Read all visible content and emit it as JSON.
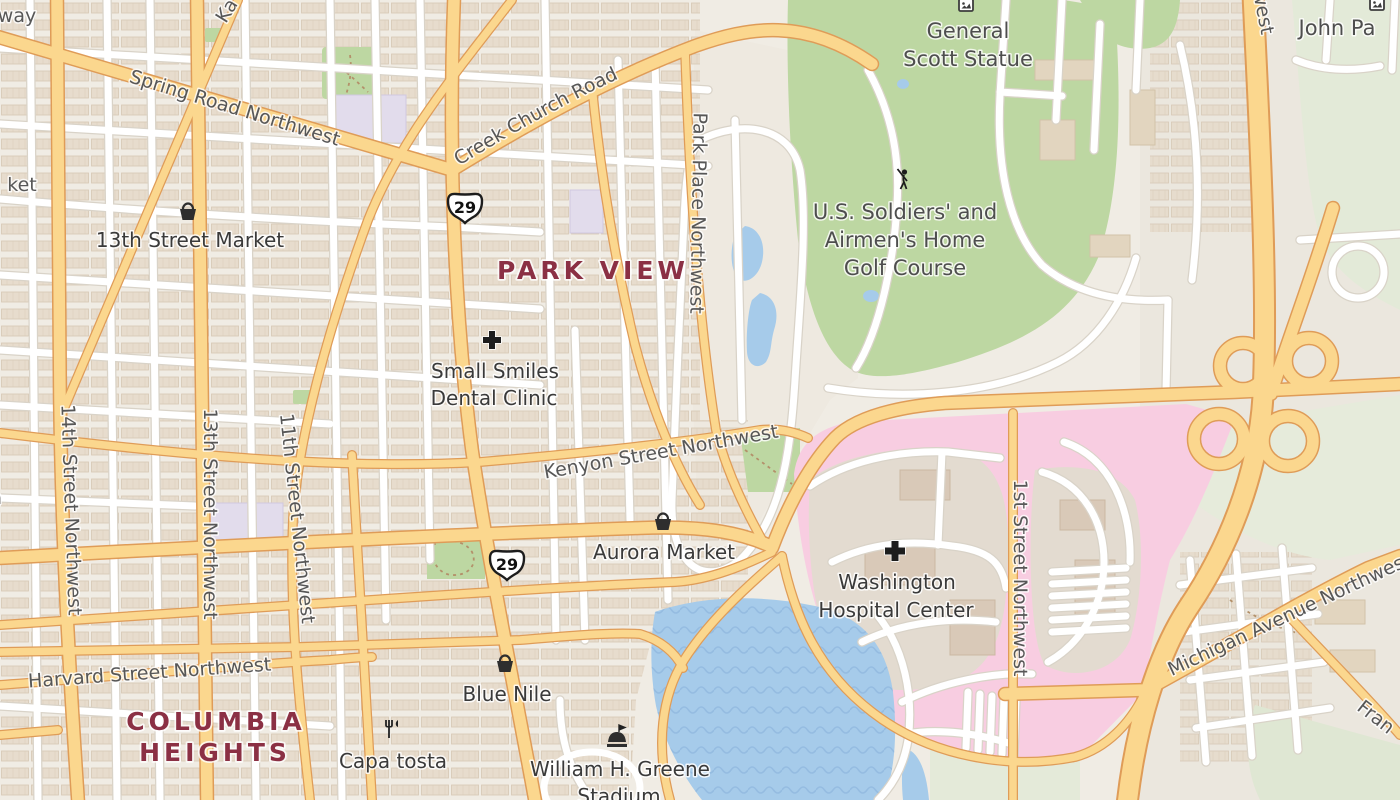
{
  "map_title": "Park View / Columbia Heights area map",
  "labels": {
    "spring_road": "Spring Road Northwest",
    "rock_creek_church": "Rock Creek Church Road",
    "park_place": "Park Place Northwest",
    "kenyon": "Kenyon Street Northwest",
    "harvard": "Harvard Street Northwest",
    "michigan": "Michigan Avenue Northwest",
    "street_14": "14th Street Northwest",
    "street_13": "13th Street Northwest",
    "street_11": "11th Street Northwest",
    "street_1": "1st Street Northwest",
    "street_nw_partial": "Street Northwest",
    "way_partial": "way",
    "ket_partial": "ket",
    "ka_partial": "Ka",
    "a_partial": "a",
    "fran_partial": "Fran",
    "john_partial": "John Pa"
  },
  "neighborhoods": {
    "park_view": "PARK VIEW",
    "columbia_1": "COLUMBIA",
    "columbia_2": "HEIGHTS"
  },
  "pois": {
    "market_13th": "13th Street Market",
    "dental_1": "Small Smiles",
    "dental_2": "Dental Clinic",
    "aurora": "Aurora Market",
    "blue_nile": "Blue Nile",
    "capa_tosta": "Capa tosta",
    "stadium_1": "William H. Greene",
    "stadium_2": "Stadium",
    "hospital_1": "Washington",
    "hospital_2": "Hospital Center",
    "golf_1": "U.S. Soldiers' and",
    "golf_2": "Airmen's Home",
    "golf_3": "Golf Course",
    "scott_1": "General",
    "scott_2": "Scott Statue"
  },
  "shields": {
    "us29": "29"
  },
  "colors": {
    "road_yellow": "#fbd78e",
    "road_casing": "#df9c58",
    "water": "#a6cbea",
    "water_wave": "#8cb4dc",
    "golf_green": "#bdd7a2",
    "light_green": "#e3ead8",
    "hospital_pink": "#f8cde1",
    "campus_beige": "#e3dbd0",
    "building": "#d9c9b8",
    "lavender": "#e2dcec",
    "residential_base": "#efe9e1",
    "neighborhood_text": "#8b3044",
    "street_text": "#575757",
    "poi_text": "#3a3a3a"
  }
}
